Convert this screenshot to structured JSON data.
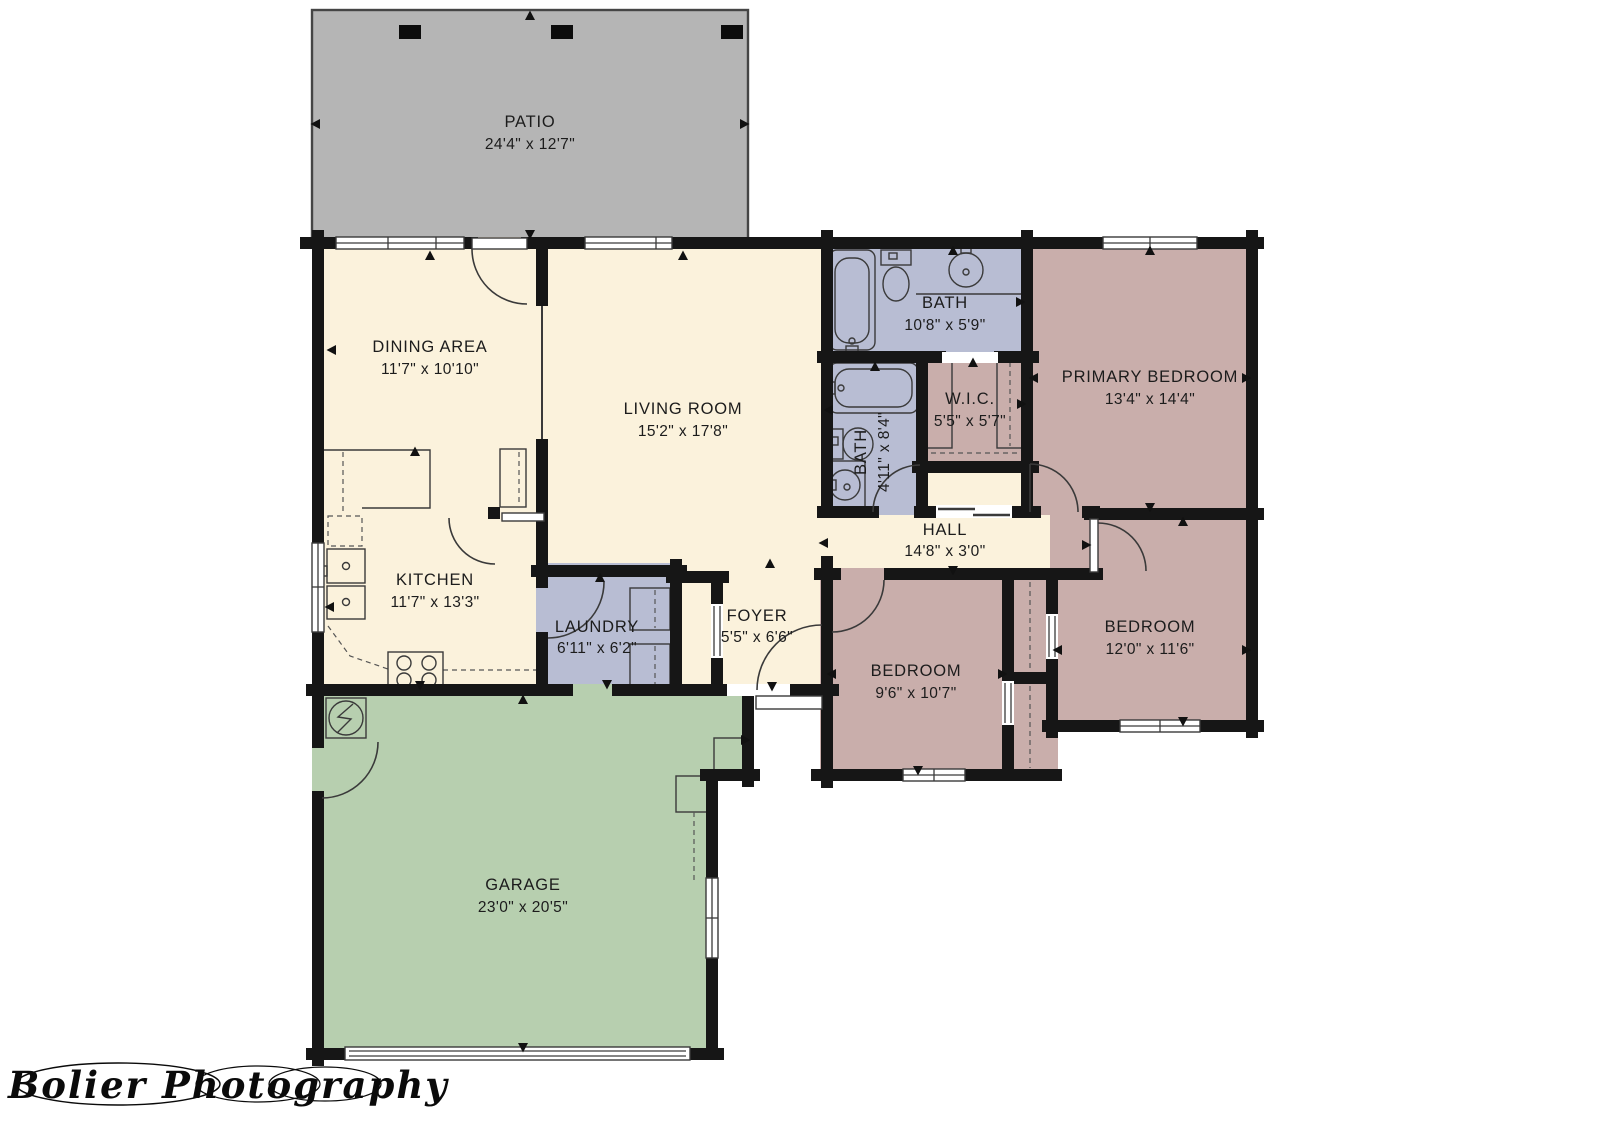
{
  "title": "Single-storey house floor plan",
  "watermark": "Bolier Photography",
  "rooms": {
    "patio": {
      "name": "PATIO",
      "dims": "24'4\" x 12'7\""
    },
    "dining": {
      "name": "DINING AREA",
      "dims": "11'7\" x 10'10\""
    },
    "living": {
      "name": "LIVING ROOM",
      "dims": "15'2\" x 17'8\""
    },
    "bath1": {
      "name": "BATH",
      "dims": "10'8\" x 5'9\""
    },
    "primary": {
      "name": "PRIMARY BEDROOM",
      "dims": "13'4\" x 14'4\""
    },
    "wic": {
      "name": "W.I.C.",
      "dims": "5'5\" x 5'7\""
    },
    "bath2": {
      "name": "BATH",
      "dims": "4'11\" x 8'4\""
    },
    "hall": {
      "name": "HALL",
      "dims": "14'8\" x 3'0\""
    },
    "kitchen": {
      "name": "KITCHEN",
      "dims": "11'7\" x 13'3\""
    },
    "laundry": {
      "name": "LAUNDRY",
      "dims": "6'11\" x 6'2\""
    },
    "foyer": {
      "name": "FOYER",
      "dims": "5'5\" x 6'6\""
    },
    "bedroom1": {
      "name": "BEDROOM",
      "dims": "9'6\" x 10'7\""
    },
    "bedroom2": {
      "name": "BEDROOM",
      "dims": "12'0\" x 11'6\""
    },
    "garage": {
      "name": "GARAGE",
      "dims": "23'0\" x 20'5\""
    }
  },
  "colors": {
    "floor_main": "#FBF2DC",
    "floor_bath": "#B8BDD3",
    "floor_bedroom": "#C9AEAB",
    "floor_garage": "#B7CFAF",
    "patio": "#B5B5B5",
    "walls": "#161616"
  }
}
